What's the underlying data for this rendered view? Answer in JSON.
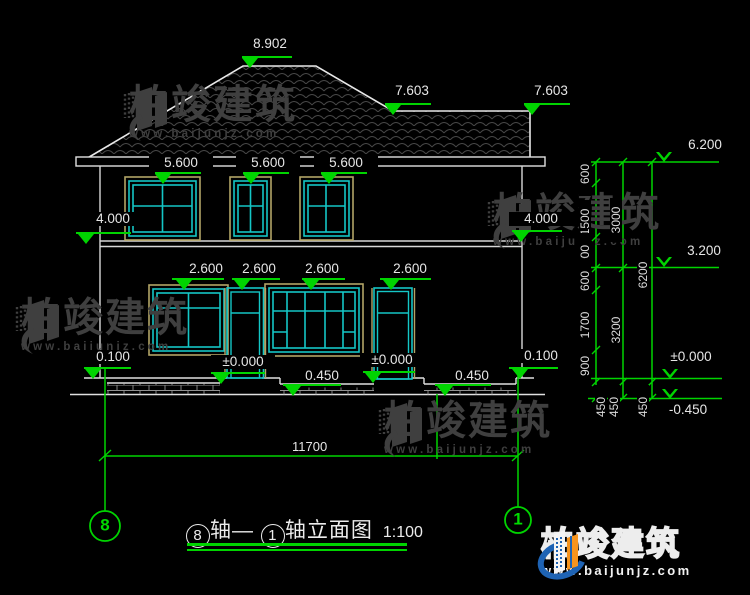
{
  "watermark": {
    "brand": "柏竣建筑",
    "url": "www.baijunjz.com"
  },
  "title_block": {
    "left_axis": "8",
    "left_label": "轴—",
    "right_axis": "1",
    "right_label": "轴立面图",
    "scale": "1:100"
  },
  "axis_bubbles": {
    "left": "8",
    "right": "1"
  },
  "elevation_markers": {
    "filled": [
      "8.902",
      "7.603",
      "7.603",
      "5.600",
      "5.600",
      "5.600",
      "4.000",
      "4.000",
      "2.600",
      "2.600",
      "2.600",
      "2.600",
      "±0.000",
      "±0.000",
      "0.100",
      "0.100",
      "0.450",
      "0.450"
    ],
    "hollow": [
      "6.200",
      "3.200",
      "±0.000",
      "-0.450"
    ]
  },
  "dimensions": {
    "floor_segments": [
      "600",
      "1500",
      "900",
      "600",
      "1700",
      "900"
    ],
    "totals": [
      "3000",
      "3200"
    ],
    "overall": [
      "6200"
    ],
    "bottom_segments": [
      "450",
      "450",
      "450"
    ],
    "overall_width": "11700"
  },
  "colors": {
    "dim_green": "#00d400",
    "frame_cyan": "#14c6c6",
    "frame_tan": "#b2a466",
    "line_white": "#e0e0e0",
    "watermark_gray": "#3f3f3f",
    "logo_blue": "#1e63b4",
    "logo_orange": "#f7941d"
  }
}
